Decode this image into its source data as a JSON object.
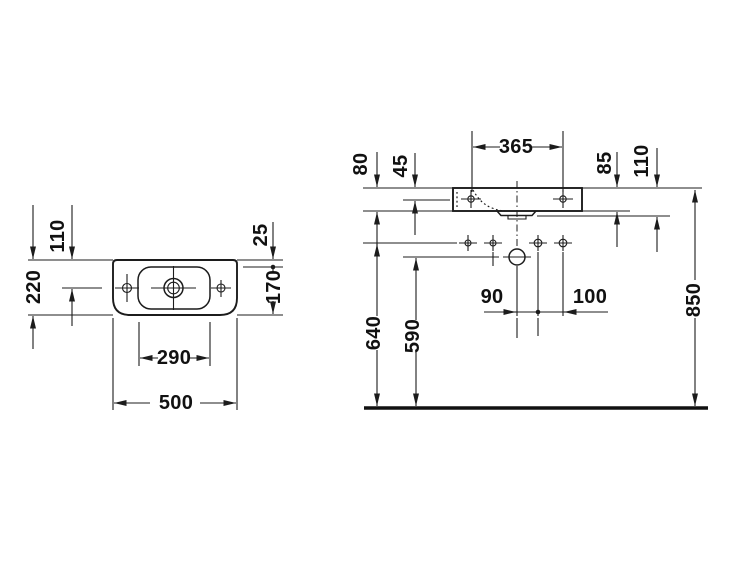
{
  "drawing": {
    "title": "washbasin-dimension-drawing",
    "colors": {
      "line": "#1c1c1c",
      "background": "#ffffff"
    },
    "top_view": {
      "overall_width": "500",
      "bowl_width": "290",
      "overall_depth": "220",
      "drain_center_from_back": "110",
      "back_ledge": "25",
      "bowl_depth": "170"
    },
    "front_view": {
      "fixing_hole_distance": "365",
      "left_rim_offset": "80",
      "left_fixing_offset": "45",
      "right_rim_offset": "85",
      "right_outlet_offset": "110",
      "outlet_left_spacing": "90",
      "outlet_right_spacing": "100",
      "supply_height": "640",
      "outlet_height": "590",
      "rim_height": "850"
    }
  }
}
